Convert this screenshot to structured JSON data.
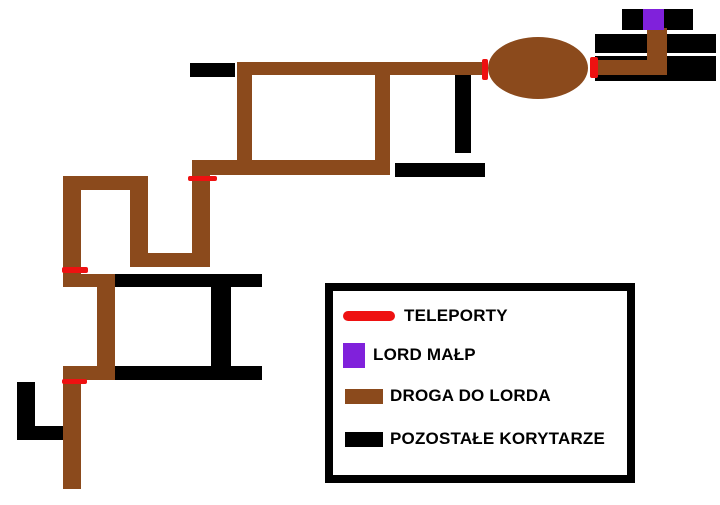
{
  "colors": {
    "teleport": "#EE1111",
    "lord": "#8021DB",
    "road": "#8B4A1C",
    "corridor": "#000000",
    "background": "#FFFFFF"
  },
  "legend": {
    "items": [
      {
        "label": "TELEPORTY",
        "swatch_icon": "teleport-line-icon",
        "color_key": "teleport"
      },
      {
        "label": "LORD MAŁP",
        "swatch_icon": "lord-square-icon",
        "color_key": "lord"
      },
      {
        "label": "DROGA DO LORDA",
        "swatch_icon": "road-bar-icon",
        "color_key": "road"
      },
      {
        "label": "POZOSTAŁE KORYTARZE",
        "swatch_icon": "corridor-bar-icon",
        "color_key": "corridor"
      }
    ]
  }
}
